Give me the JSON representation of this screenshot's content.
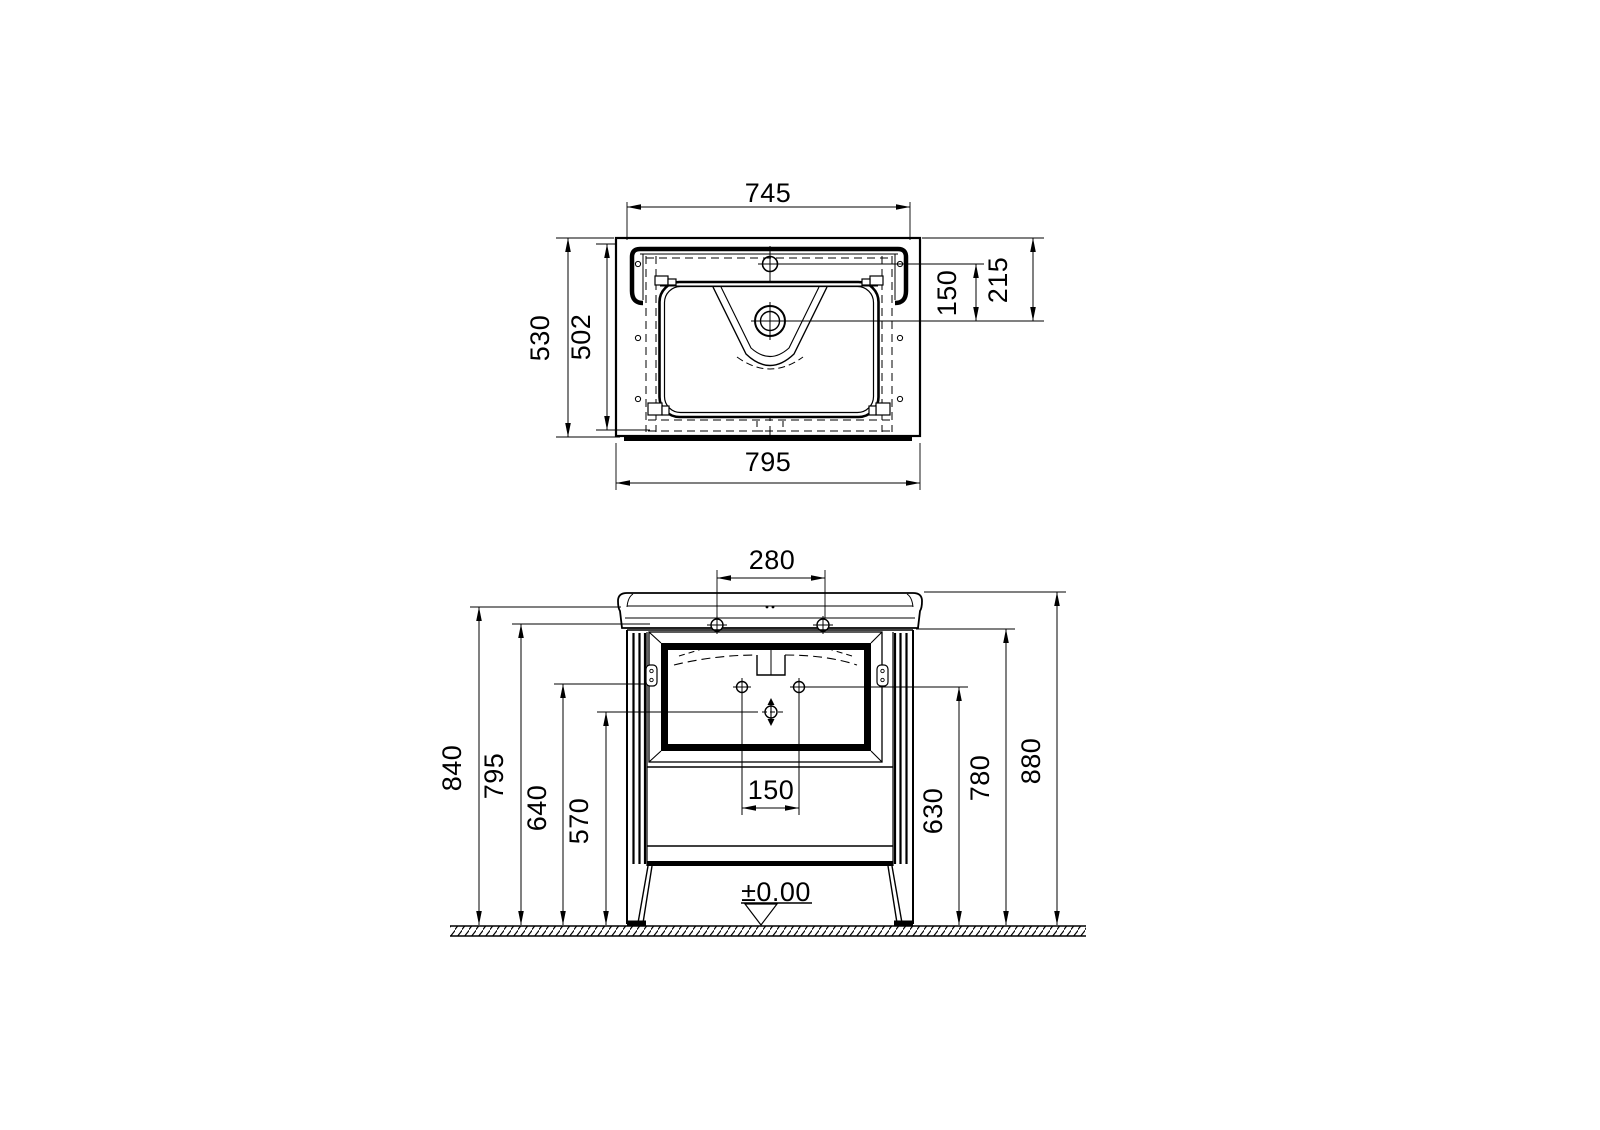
{
  "drawing": {
    "background": "#ffffff",
    "line_color": "#000000",
    "top_view": {
      "name": "washbasin plan view",
      "dims": {
        "basin_width": "745",
        "total_depth": "530",
        "inner_depth": "502",
        "faucet_to_drain": "150",
        "edge_to_drain": "215",
        "total_width": "795"
      }
    },
    "front_view": {
      "name": "washbasin unit front elevation",
      "dims": {
        "faucet_holes_span": "280",
        "sink_back_height": "840",
        "cabinet_top_height": "795",
        "bracket_height": "640",
        "drain_height": "570",
        "drain_spacing": "150",
        "floor_level": "±0.00",
        "hole_height": "630",
        "holes_line_height": "780",
        "total_height": "880"
      }
    }
  }
}
